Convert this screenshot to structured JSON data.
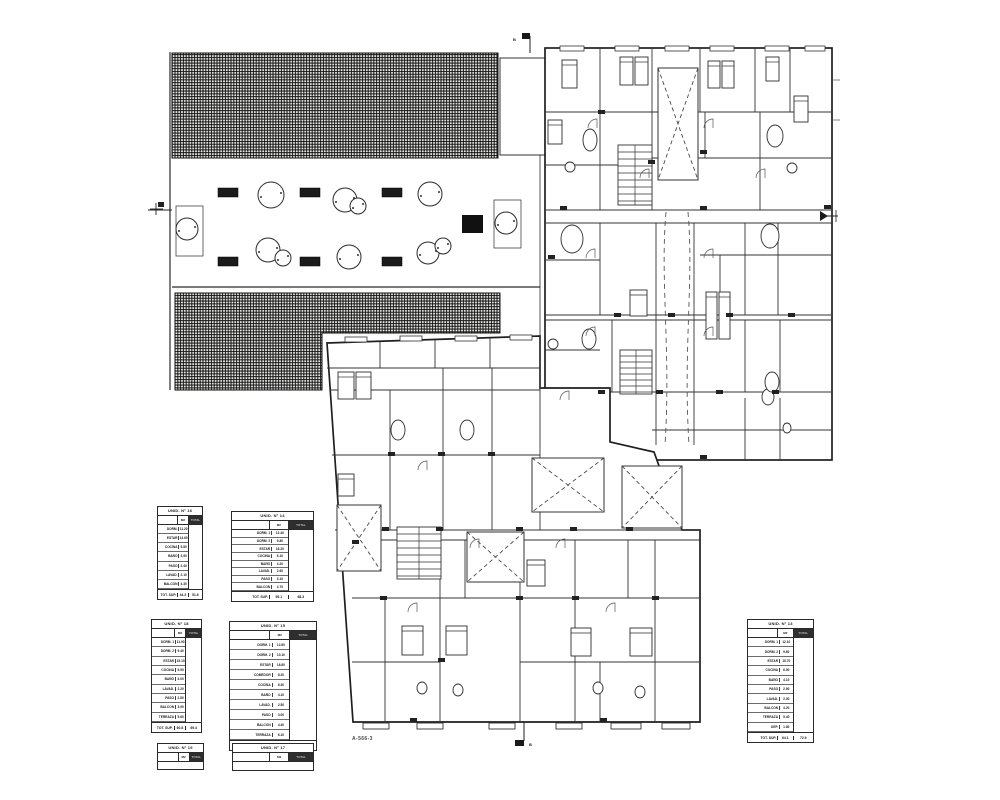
{
  "drawing": {
    "sheet_label": "A-566-3",
    "section_marker_top": "B",
    "section_marker_bottom": "B"
  },
  "tables": [
    {
      "title": "UNID. N° 16",
      "col_m2": "M2",
      "col_total": "TOTAL",
      "rows": [
        [
          "DORM.",
          "11.20"
        ],
        [
          "ESTAR",
          "14.60"
        ],
        [
          "COCINA",
          "5.80"
        ],
        [
          "BAÑO",
          "3.90"
        ],
        [
          "PASO",
          "2.40"
        ],
        [
          "LAVAD.",
          "2.10"
        ],
        [
          "BALCON",
          "4.30"
        ]
      ],
      "total_label": "TOT. SUP.",
      "total_m2": "44.3",
      "total_value": "51.6"
    },
    {
      "title": "UNID. N° 14",
      "col_m2": "M2",
      "col_total": "TOTAL",
      "rows": [
        [
          "DORM. 1",
          "12.40"
        ],
        [
          "DORM. 2",
          "9.80"
        ],
        [
          "ESTAR",
          "16.20"
        ],
        [
          "COCINA",
          "6.10"
        ],
        [
          "BAÑO",
          "4.20"
        ],
        [
          "LAVAD.",
          "2.60"
        ],
        [
          "PASO",
          "3.10"
        ],
        [
          "BALCON",
          "4.70"
        ]
      ],
      "total_label": "TOT. SUP.",
      "total_m2": "59.1",
      "total_value": "68.3"
    },
    {
      "title": "UNID. N° 18",
      "col_m2": "M2",
      "col_total": "TOTAL",
      "rows": [
        [
          "DORM. 1",
          "11.90"
        ],
        [
          "DORM. 2",
          "9.40"
        ],
        [
          "ESTAR",
          "15.10"
        ],
        [
          "COCINA",
          "5.90"
        ],
        [
          "BAÑO",
          "4.00"
        ],
        [
          "LAVAD.",
          "2.20"
        ],
        [
          "PASO",
          "2.80"
        ],
        [
          "BALCON",
          "3.90"
        ],
        [
          "TERRAZA",
          "5.60"
        ]
      ],
      "total_label": "TOT. SUP.",
      "total_m2": "60.8",
      "total_value": "69.4"
    },
    {
      "title": "UNID. N° 15",
      "col_m2": "M2",
      "col_total": "TOTAL",
      "rows": [
        [
          "DORM. 1",
          "12.60"
        ],
        [
          "DORM. 2",
          "10.10"
        ],
        [
          "ESTAR",
          "16.80"
        ],
        [
          "COMEDOR",
          "8.20"
        ],
        [
          "COCINA",
          "6.30"
        ],
        [
          "BAÑO",
          "4.10"
        ],
        [
          "LAVAD.",
          "2.50"
        ],
        [
          "PASO",
          "3.00"
        ],
        [
          "BALCON",
          "4.40"
        ],
        [
          "TERRAZA",
          "6.10"
        ]
      ],
      "total_label": "TOT. SUP.",
      "total_m2": "74.1",
      "total_value": "82.7"
    },
    {
      "title": "UNID. N° 13",
      "col_m2": "M2",
      "col_total": "TOTAL",
      "rows": [
        [
          "DORM. 1",
          "12.10"
        ],
        [
          "DORM. 2",
          "9.60"
        ],
        [
          "ESTAR",
          "15.70"
        ],
        [
          "COCINA",
          "6.00"
        ],
        [
          "BAÑO",
          "4.10"
        ],
        [
          "PASO",
          "2.90"
        ],
        [
          "LAVAD.",
          "2.30"
        ],
        [
          "BALCON",
          "4.20"
        ],
        [
          "TERRAZA",
          "5.40"
        ],
        [
          "DEP.",
          "1.80"
        ]
      ],
      "total_label": "TOT. SUP.",
      "total_m2": "64.1",
      "total_value": "72.9"
    },
    {
      "title": "UNID. N° 19",
      "col_m2": "M2",
      "col_total": "TOTAL",
      "rows": [],
      "total_label": "",
      "total_m2": "",
      "total_value": ""
    },
    {
      "title": "UNID. N° 17",
      "col_m2": "M2",
      "col_total": "TOTAL",
      "rows": [],
      "total_label": "",
      "total_m2": "",
      "total_value": ""
    }
  ]
}
